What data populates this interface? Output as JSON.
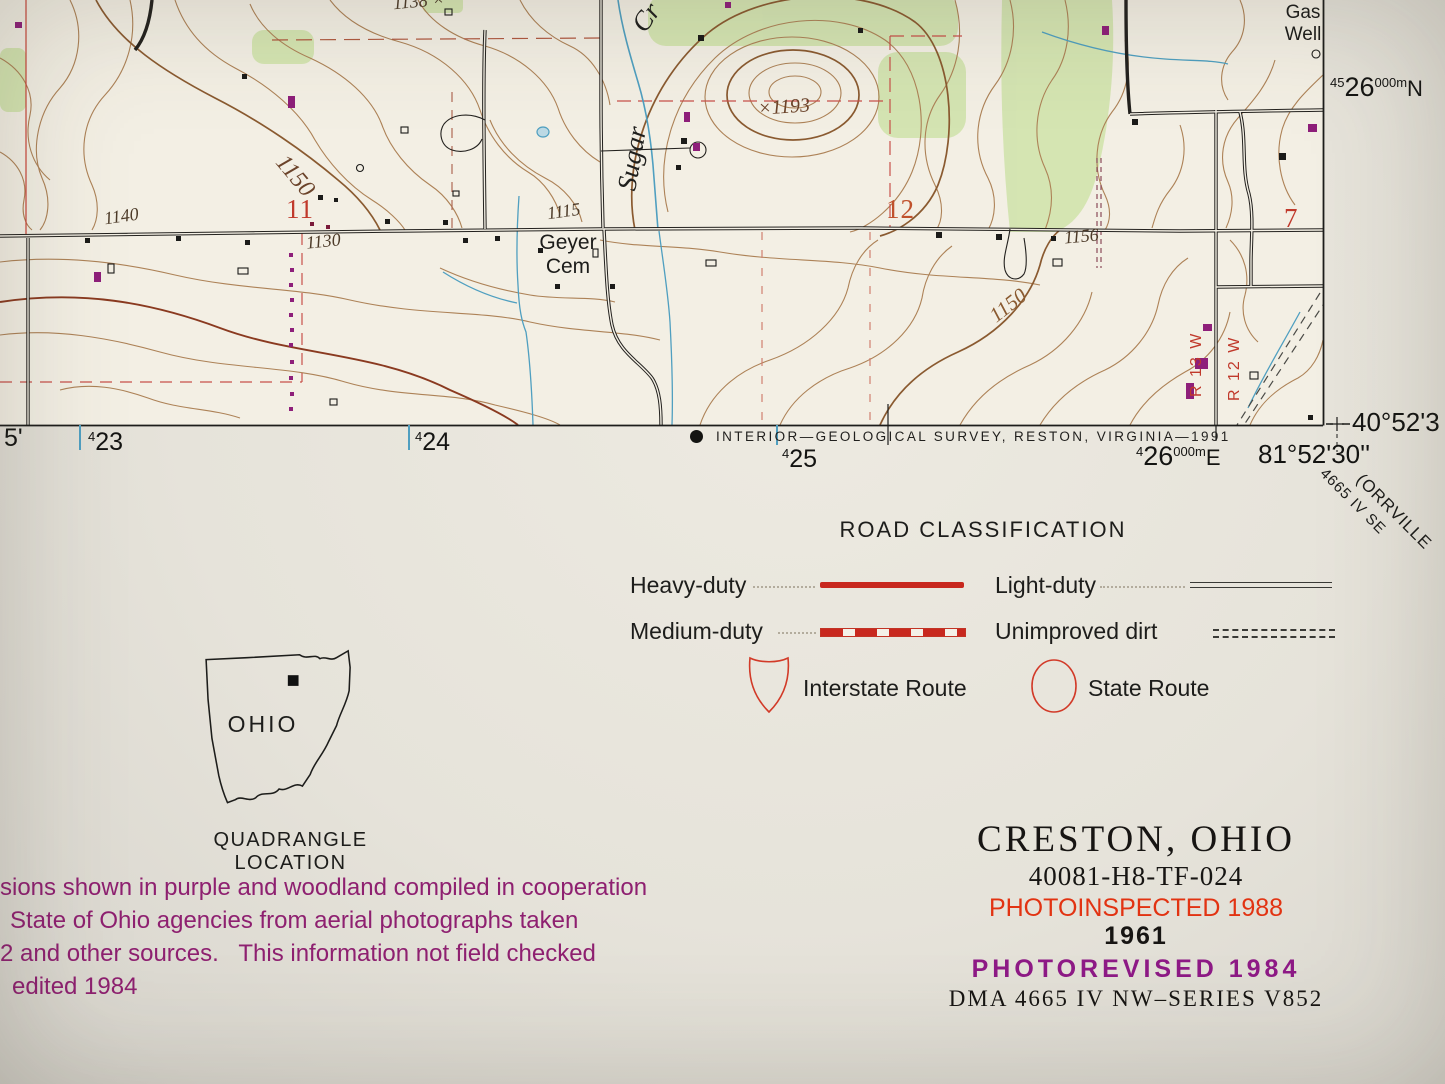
{
  "map": {
    "sections": {
      "s11": "11",
      "s12": "12",
      "s7": "7"
    },
    "elevations": {
      "e1150a": "1150",
      "e1140": "1140",
      "e1130": "1130",
      "e1115": "1115",
      "e1156": "1156",
      "e1150b": "1150",
      "e1193": "×1193",
      "e1138": "1138 ×"
    },
    "places": {
      "sugar": "Sugar",
      "cr": "Cr",
      "geyer_line1": "Geyer",
      "geyer_line2": "Cem",
      "gas_line1": "Gas",
      "gas_line2": "Well",
      "r13w": "R 13 W",
      "r12w": "R 12 W"
    }
  },
  "collar": {
    "minute_left": "5'",
    "grid_423_pre": "4",
    "grid_423_num": "23",
    "grid_424_pre": "4",
    "grid_424_num": "24",
    "grid_425_pre": "4",
    "grid_425_num": "25",
    "grid_426_pre": "4",
    "grid_426_num": "26",
    "grid_426_small": "000m",
    "grid_426_suffix": "E",
    "grid_4526_pre": "45",
    "grid_4526_num": "26",
    "grid_4526_small": "000m",
    "grid_4526_suffix": "N",
    "credit": "INTERIOR—GEOLOGICAL SURVEY, RESTON, VIRGINIA—1991",
    "corner_lat": "40°52'3",
    "corner_lon": "81°52'30''",
    "adjoining_line1": "(ORRVILLE",
    "adjoining_line2": "4665 IV SE"
  },
  "legend": {
    "title": "ROAD CLASSIFICATION",
    "heavy": "Heavy-duty",
    "medium": "Medium-duty",
    "light": "Light-duty",
    "unimproved": "Unimproved dirt",
    "interstate": "Interstate Route",
    "state_route": "State Route"
  },
  "location_inset": {
    "state_name": "OHIO",
    "caption": "QUADRANGLE LOCATION"
  },
  "revision_note": {
    "line1": "sions shown in purple and woodland compiled in cooperation",
    "line2": "State of Ohio agencies from aerial photographs taken",
    "line3": "2 and other sources.   This information not field checked",
    "line4": "edited 1984"
  },
  "title_block": {
    "quad_name": "CRESTON, OHIO",
    "map_id": "40081-H8-TF-024",
    "photoinspected": "PHOTOINSPECTED 1988",
    "base_year": "1961",
    "photorevised": "PHOTOREVISED 1984",
    "series": "DMA 4665 IV NW–SERIES V852"
  },
  "colors": {
    "road_red": "#c8281e",
    "section_red": "#c04030",
    "revision_purple": "#8e1f7a",
    "photoinspected_red": "#e23312",
    "woodland_green": "#d2e4ae",
    "water_blue": "#4f9fc0",
    "contour_brown": "#ad8257",
    "contour_index_brown": "#8a5a30"
  }
}
